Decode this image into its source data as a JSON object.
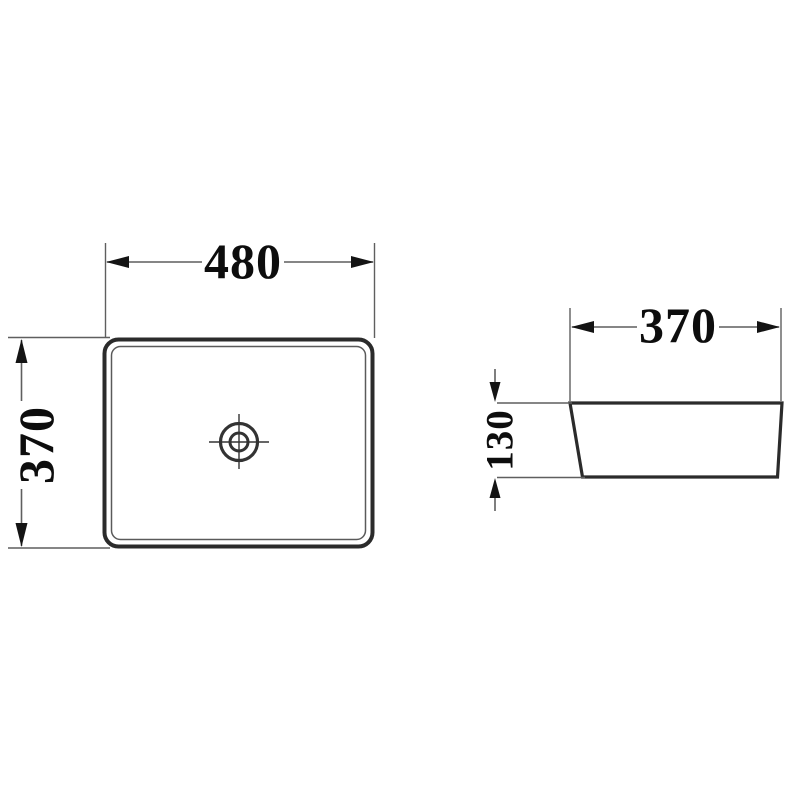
{
  "drawing": {
    "kind": "basin-technical-drawing",
    "background": "#ffffff",
    "colors": {
      "outline": "#2b2b2b",
      "dimension_line": "#5f5f5f",
      "arrow": "#141414",
      "text": "#0d0d0d"
    },
    "top_view": {
      "icon": "drain-crosshair-icon",
      "dimensions": {
        "width": "480",
        "height": "370"
      }
    },
    "side_view": {
      "dimensions": {
        "width": "370",
        "height": "130"
      }
    }
  }
}
